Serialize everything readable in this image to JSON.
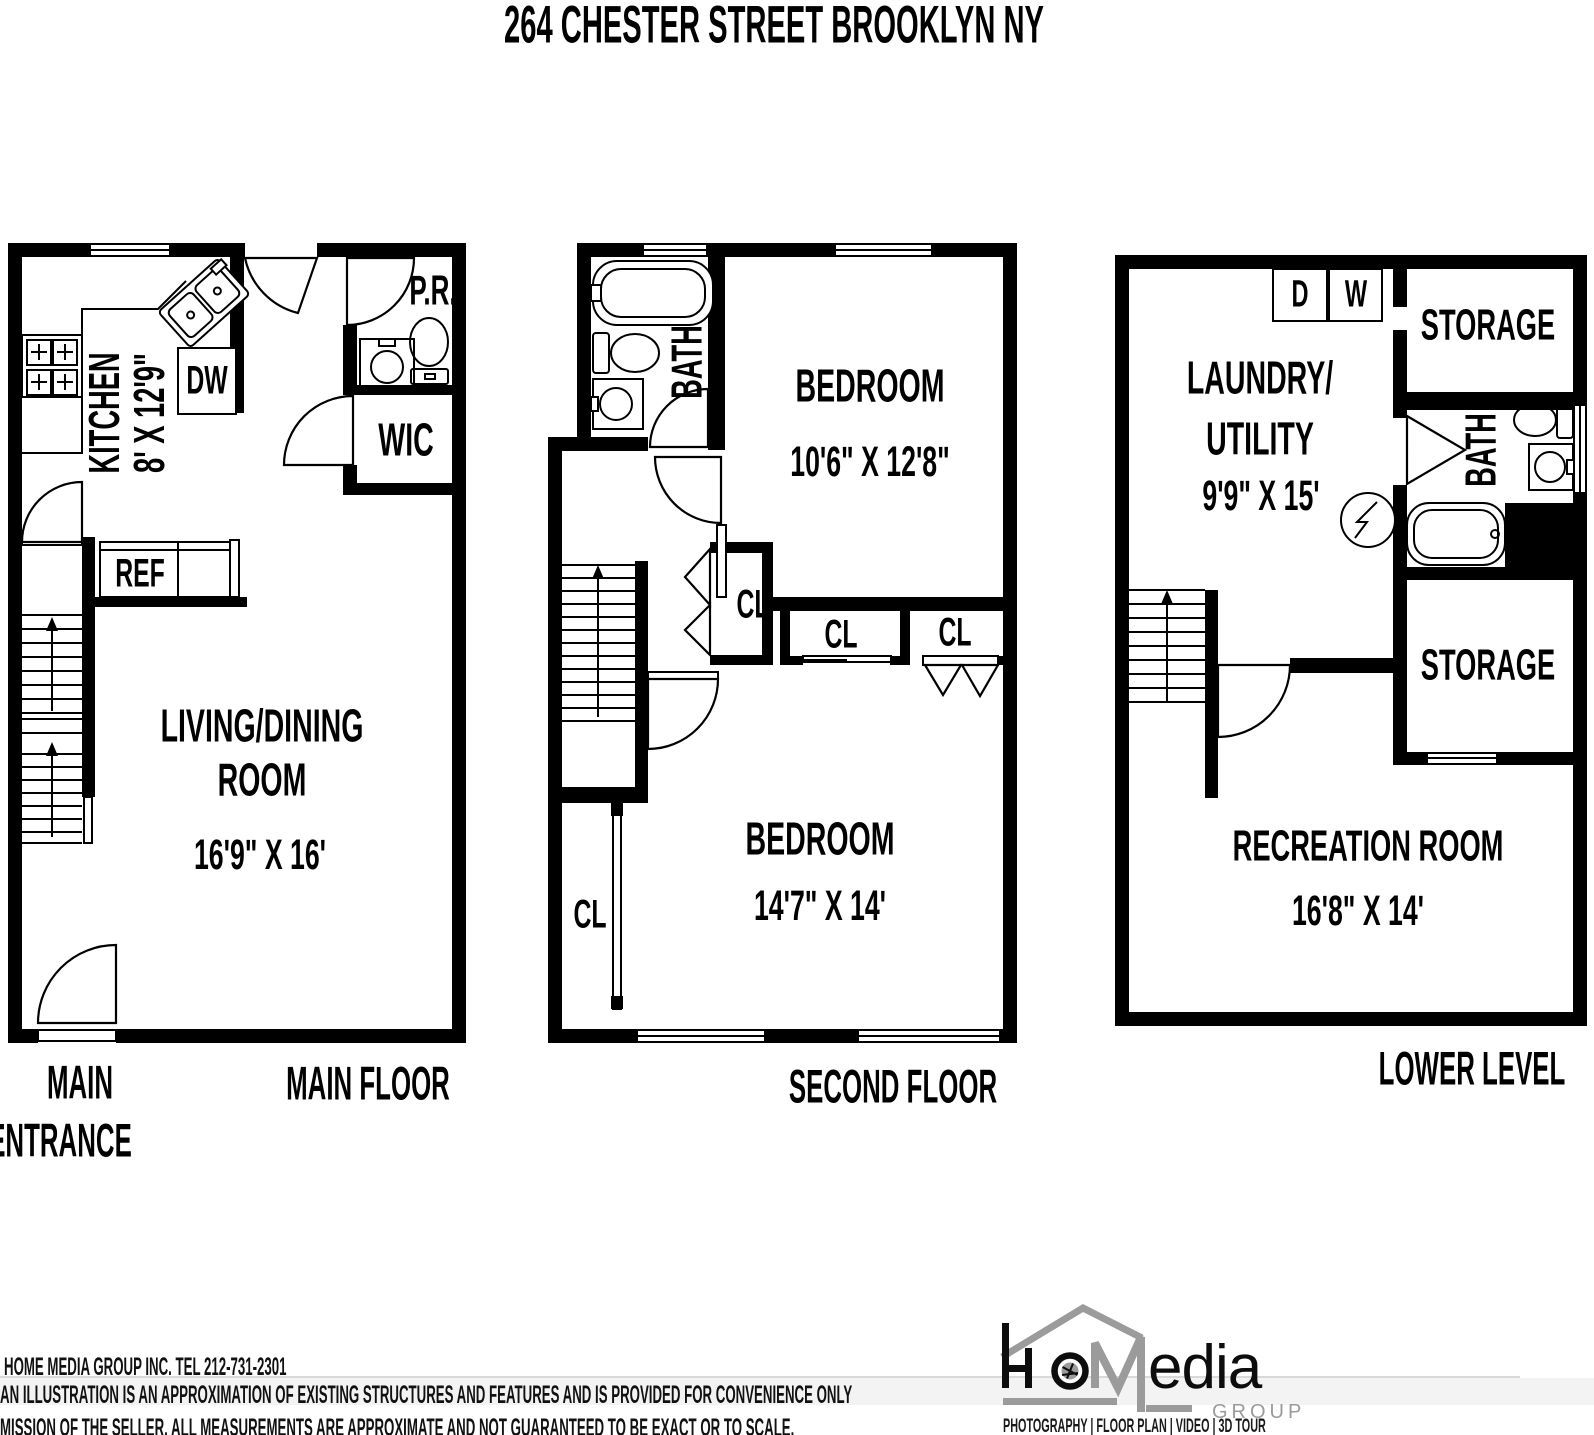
{
  "title": "264 CHESTER STREET BROOKLYN NY",
  "floors": {
    "main": {
      "caption": "MAIN FLOOR",
      "entrance_line1": "MAIN",
      "entrance_line2": "ENTRANCE",
      "kitchen_label": "KITCHEN",
      "kitchen_dims": "8' X 12'9\"",
      "dishwasher": "DW",
      "refrigerator": "REF",
      "powder_room": "P.R.",
      "walk_in_closet": "WIC",
      "living_line1": "LIVING/DINING",
      "living_line2": "ROOM",
      "living_dims": "16'9\" X 16'"
    },
    "second": {
      "caption": "SECOND FLOOR",
      "bath": "BATH",
      "bedroom1_label": "BEDROOM",
      "bedroom1_dims": "10'6\" X 12'8\"",
      "closet1": "CL",
      "closet2": "CL",
      "closet3": "CL",
      "closet4": "CL",
      "bedroom2_label": "BEDROOM",
      "bedroom2_dims": "14'7\" X 14'"
    },
    "lower": {
      "caption": "LOWER LEVEL",
      "dryer": "D",
      "washer": "W",
      "storage1": "STORAGE",
      "laundry_line1": "LAUNDRY/",
      "laundry_line2": "UTILITY",
      "laundry_dims": "9'9\" X 15'",
      "bath": "BATH",
      "storage2": "STORAGE",
      "recreation_label": "RECREATION ROOM",
      "recreation_dims": "16'8\" X 14'"
    }
  },
  "footer": {
    "line1": "HOME MEDIA GROUP INC.  TEL 212-731-2301",
    "line2": "AN ILLUSTRATION IS AN APPROXIMATION OF EXISTING STRUCTURES AND FEATURES AND IS PROVIDED FOR CONVENIENCE ONLY",
    "line3": "MISSION OF THE SELLER. ALL MEASUREMENTS ARE APPROXIMATE AND NOT GUARANTEED TO BE EXACT OR TO SCALE."
  },
  "logo": {
    "name": "HoMedia",
    "suffix": "edia",
    "group": "GROUP",
    "tagline": "PHOTOGRAPHY | FLOOR PLAN | VIDEO | 3D TOUR",
    "gray": "#9b9b9b",
    "black": "#0d0d0d"
  }
}
